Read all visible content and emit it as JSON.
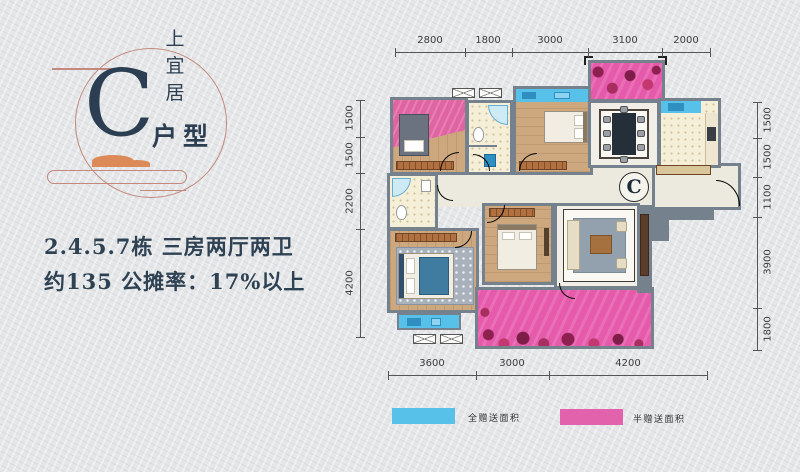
{
  "logo": {
    "brand_chars": [
      "上",
      "宜",
      "居"
    ],
    "unit_letter": "C",
    "unit_suffix": "户型"
  },
  "description": {
    "line1": "2.4.5.7栋  三房两厅两卫",
    "line2": "约135  公摊率：17%以上"
  },
  "plan": {
    "unit_marker": "C",
    "dimensions": {
      "top": [
        "2800",
        "1800",
        "3000",
        "3100",
        "2000"
      ],
      "left": [
        "1500",
        "1500",
        "2200",
        "4200"
      ],
      "right": [
        "1500",
        "1500",
        "1100",
        "3900",
        "1800"
      ],
      "bottom": [
        "3600",
        "3000",
        "4200"
      ]
    }
  },
  "legend": {
    "full_gift": {
      "label": "全赠送面积",
      "color": "#58c1e9"
    },
    "half_gift": {
      "label": "半赠送面积",
      "color": "#e263ac"
    }
  },
  "colors": {
    "accent_navy": "#2b3e52",
    "accent_salmon": "#c2897c",
    "accent_orange": "#dc8a58",
    "wall_gray": "#75828d",
    "gift_full_blue": "#58c1e9",
    "gift_half_pink": "#e263ac"
  }
}
